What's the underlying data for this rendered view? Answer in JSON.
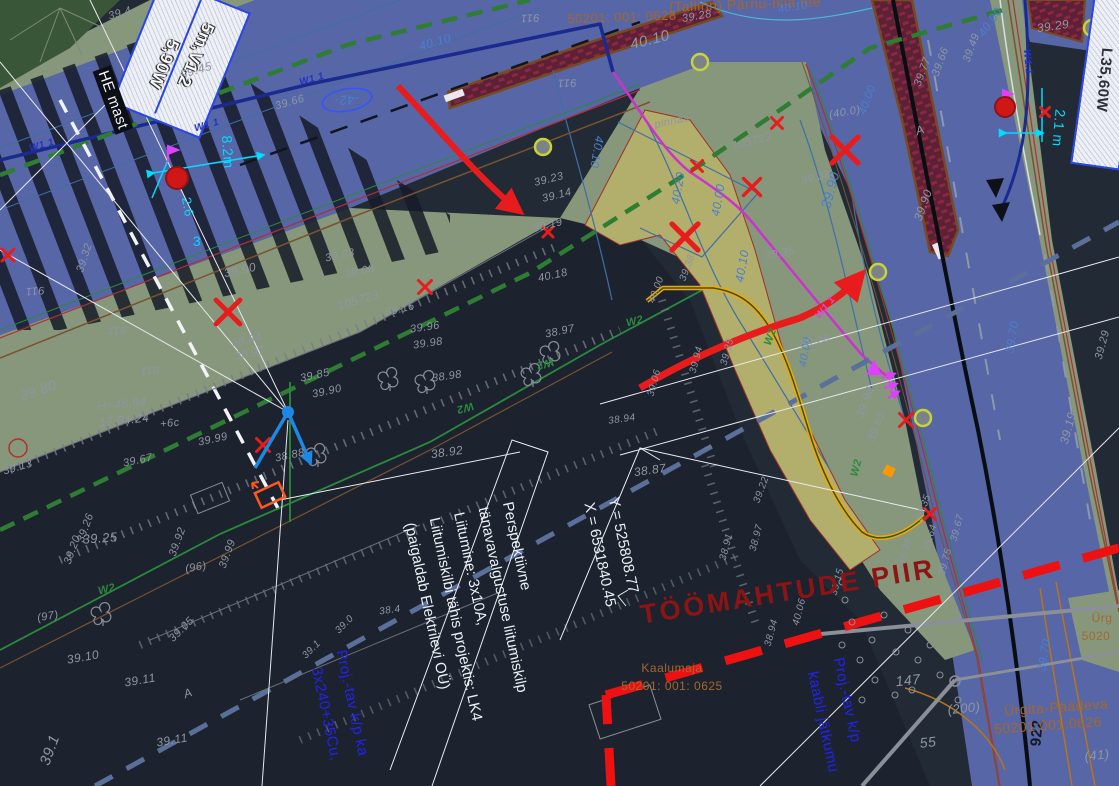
{
  "canvas": {
    "width": 1119,
    "height": 786,
    "background": "#222a36"
  },
  "colors": {
    "road_blue": "#5766a6",
    "verge_green": "#87977b",
    "khaki": "#b2ae6c",
    "forest": "#3a5639",
    "median_maroon": "#5c2136",
    "median_border": "#7a4a1f",
    "work_boundary_red": "#ee1111",
    "cable_orange": "#ffa000",
    "water_navy": "#1b2a8f",
    "water_magenta": "#cc33cc",
    "dash_green": "#2e7d32",
    "dash_slate": "#5a6f9a",
    "contour_blue": "#3d6fa8",
    "accent_cyan": "#00dcff"
  },
  "notes": {
    "main": {
      "x": 480,
      "y": 614,
      "rot": 78,
      "lines": [
        "Perspektiivne",
        "tänavavalgustuse liitumiskilp",
        "Liitumine: 3x10A,",
        "Liitumiskilbi tähis projektis: LK4",
        "(paigaldab Elektrilevi OÜ)"
      ]
    },
    "coords": {
      "x": 612,
      "y": 552,
      "rot": 78,
      "lines": [
        "Y = 525808.77",
        "X = 6531840.45"
      ]
    }
  },
  "labels": [
    {
      "t": "(Tallinn) Pärnu-Ikla tee",
      "x": 745,
      "y": 4,
      "r": -2,
      "s": 14,
      "c": "sienna"
    },
    {
      "t": "50201: 001: 0628",
      "x": 622,
      "y": 17,
      "r": -2,
      "s": 13,
      "c": "sienna"
    },
    {
      "t": "39.28",
      "x": 697,
      "y": 17,
      "r": -10,
      "s": 11,
      "c": "gray"
    },
    {
      "t": "40.10",
      "x": 650,
      "y": 40,
      "r": -14,
      "s": 15,
      "c": "gray"
    },
    {
      "t": "40.10",
      "x": 793,
      "y": 8,
      "r": -8,
      "s": 11,
      "c": "blue"
    },
    {
      "t": "40.10",
      "x": 435,
      "y": 42,
      "r": -16,
      "s": 12,
      "c": "blue"
    },
    {
      "t": "40.10",
      "x": 597,
      "y": 152,
      "r": 100,
      "s": 12,
      "c": "blue"
    },
    {
      "t": "40.00",
      "x": 990,
      "y": 22,
      "r": -55,
      "s": 12,
      "c": "blue"
    },
    {
      "t": "39.29",
      "x": 1053,
      "y": 26,
      "r": -8,
      "s": 12,
      "c": "gray"
    },
    {
      "t": "39.45",
      "x": 196,
      "y": 70,
      "r": -16,
      "s": 12,
      "c": "gray"
    },
    {
      "t": "39.4",
      "x": 120,
      "y": 14,
      "r": -16,
      "s": 11,
      "c": "gray"
    },
    {
      "t": "W1 1",
      "x": 42,
      "y": 146,
      "r": -16,
      "s": 10,
      "c": "navy"
    },
    {
      "t": "W1 1",
      "x": 207,
      "y": 126,
      "r": -16,
      "s": 10,
      "c": "navy"
    },
    {
      "t": "W1 1",
      "x": 312,
      "y": 80,
      "r": -16,
      "s": 10,
      "c": "navy"
    },
    {
      "t": "W1.1",
      "x": 1027,
      "y": 62,
      "r": 85,
      "s": 10,
      "c": "navy"
    },
    {
      "t": "W1 1",
      "x": 826,
      "y": 308,
      "r": -52,
      "s": 10,
      "c": "magenta"
    },
    {
      "t": "-42-",
      "x": 347,
      "y": 100,
      "r": 175,
      "s": 13,
      "c": "blue"
    },
    {
      "t": "911",
      "x": 530,
      "y": 17,
      "r": 178,
      "s": 11,
      "c": "gray"
    },
    {
      "t": "911",
      "x": 567,
      "y": 82,
      "r": 178,
      "s": 11,
      "c": "gray"
    },
    {
      "t": "911",
      "x": 35,
      "y": 290,
      "r": 175,
      "s": 11,
      "c": "gray"
    },
    {
      "t": "911",
      "x": 117,
      "y": 330,
      "r": 175,
      "s": 11,
      "c": "gray"
    },
    {
      "t": "911",
      "x": 150,
      "y": 370,
      "r": 175,
      "s": 11,
      "c": "gray"
    },
    {
      "t": "39.66",
      "x": 290,
      "y": 103,
      "r": -16,
      "s": 11,
      "c": "gray"
    },
    {
      "t": "8.2m",
      "x": 228,
      "y": 152,
      "r": 86,
      "s": 14,
      "c": "cyan"
    },
    {
      "t": "2.6",
      "x": 188,
      "y": 207,
      "r": 80,
      "s": 13,
      "c": "cyan"
    },
    {
      "t": "2.1 m",
      "x": 1059,
      "y": 128,
      "r": 95,
      "s": 14,
      "c": "cyan"
    },
    {
      "t": "3",
      "x": 197,
      "y": 241,
      "r": 0,
      "s": 14,
      "c": "cyan"
    },
    {
      "t": "HE mast",
      "x": 113,
      "y": 100,
      "r": 70,
      "s": 15,
      "c": "whitebox"
    },
    {
      "t": "5m,V1.2",
      "x": 196,
      "y": 55,
      "r": 113,
      "s": 17,
      "c": "whiteoutline"
    },
    {
      "t": "5,90W",
      "x": 164,
      "y": 64,
      "r": 113,
      "s": 17,
      "c": "whiteoutline"
    },
    {
      "t": "L35,60W",
      "x": 1104,
      "y": 80,
      "r": 95,
      "s": 15,
      "c": "dark"
    },
    {
      "t": "39.23",
      "x": 549,
      "y": 180,
      "r": -14,
      "s": 11,
      "c": "gray"
    },
    {
      "t": "39.14",
      "x": 557,
      "y": 196,
      "r": -14,
      "s": 11,
      "c": "gray"
    },
    {
      "t": "39.19",
      "x": 548,
      "y": 226,
      "r": -14,
      "s": 11,
      "c": "gray"
    },
    {
      "t": "pinnas",
      "x": 672,
      "y": 122,
      "r": -12,
      "s": 11,
      "c": "gray"
    },
    {
      "t": "105723",
      "x": 358,
      "y": 300,
      "r": -16,
      "s": 12,
      "c": "gray"
    },
    {
      "t": "105723",
      "x": 752,
      "y": 142,
      "r": -14,
      "s": 11,
      "c": "gray"
    },
    {
      "t": "39.03",
      "x": 340,
      "y": 256,
      "r": -12,
      "s": 11,
      "c": "gray"
    },
    {
      "t": "39.03",
      "x": 360,
      "y": 272,
      "r": -12,
      "s": 11,
      "c": "gray"
    },
    {
      "t": "39.16",
      "x": 400,
      "y": 310,
      "r": -14,
      "s": 11,
      "c": "gray"
    },
    {
      "t": "40.18",
      "x": 553,
      "y": 276,
      "r": -12,
      "s": 11,
      "c": "gray"
    },
    {
      "t": "39.96",
      "x": 425,
      "y": 328,
      "r": -8,
      "s": 11,
      "c": "gray"
    },
    {
      "t": "39.98",
      "x": 428,
      "y": 344,
      "r": -8,
      "s": 11,
      "c": "gray"
    },
    {
      "t": "38.97",
      "x": 560,
      "y": 332,
      "r": -12,
      "s": 11,
      "c": "gray"
    },
    {
      "t": "38.98",
      "x": 447,
      "y": 377,
      "r": -8,
      "s": 11,
      "c": "gray"
    },
    {
      "t": "38.92",
      "x": 447,
      "y": 452,
      "r": -8,
      "s": 12,
      "c": "gray"
    },
    {
      "t": "38.87",
      "x": 650,
      "y": 470,
      "r": -8,
      "s": 12,
      "c": "gray"
    },
    {
      "t": "39.85",
      "x": 315,
      "y": 376,
      "r": -12,
      "s": 11,
      "c": "gray"
    },
    {
      "t": "39.90",
      "x": 327,
      "y": 392,
      "r": -12,
      "s": 11,
      "c": "gray"
    },
    {
      "t": "39.80",
      "x": 38,
      "y": 390,
      "r": -18,
      "s": 14,
      "c": "gray"
    },
    {
      "t": "39.32",
      "x": 85,
      "y": 258,
      "r": -72,
      "s": 11,
      "c": "gray"
    },
    {
      "t": "39.90",
      "x": 240,
      "y": 270,
      "r": -12,
      "s": 12,
      "c": "gray"
    },
    {
      "t": "38.84",
      "x": 247,
      "y": 341,
      "r": -12,
      "s": 11,
      "c": "gray"
    },
    {
      "t": "38.97",
      "x": 250,
      "y": 354,
      "r": -12,
      "s": 11,
      "c": "gray"
    },
    {
      "t": "H=46.94",
      "x": 122,
      "y": 404,
      "r": -6,
      "s": 12,
      "c": "gray"
    },
    {
      "t": "17.04.24",
      "x": 124,
      "y": 420,
      "r": -6,
      "s": 12,
      "c": "gray"
    },
    {
      "t": "+6c",
      "x": 170,
      "y": 424,
      "r": -6,
      "s": 11,
      "c": "gray"
    },
    {
      "t": "39.99",
      "x": 213,
      "y": 440,
      "r": -12,
      "s": 11,
      "c": "gray"
    },
    {
      "t": "38.88",
      "x": 290,
      "y": 456,
      "r": -12,
      "s": 11,
      "c": "gray"
    },
    {
      "t": "39.13",
      "x": 18,
      "y": 468,
      "r": -16,
      "s": 11,
      "c": "gray"
    },
    {
      "t": "39.67",
      "x": 138,
      "y": 461,
      "r": -12,
      "s": 11,
      "c": "gray"
    },
    {
      "t": "39.25",
      "x": 100,
      "y": 538,
      "r": -4,
      "s": 13,
      "c": "gray"
    },
    {
      "t": "39.26",
      "x": 86,
      "y": 528,
      "r": -70,
      "s": 11,
      "c": "gray"
    },
    {
      "t": "39.20",
      "x": 73,
      "y": 550,
      "r": -70,
      "s": 11,
      "c": "gray"
    },
    {
      "t": "39.92",
      "x": 178,
      "y": 542,
      "r": -70,
      "s": 11,
      "c": "gray"
    },
    {
      "t": "39.99",
      "x": 228,
      "y": 554,
      "r": -70,
      "s": 11,
      "c": "gray"
    },
    {
      "t": "(96)",
      "x": 196,
      "y": 568,
      "r": -10,
      "s": 11,
      "c": "gray"
    },
    {
      "t": "(97)",
      "x": 48,
      "y": 617,
      "r": -10,
      "s": 11,
      "c": "gray"
    },
    {
      "t": "39.05",
      "x": 182,
      "y": 630,
      "r": -45,
      "s": 11,
      "c": "gray"
    },
    {
      "t": "39.10",
      "x": 83,
      "y": 657,
      "r": -10,
      "s": 12,
      "c": "gray"
    },
    {
      "t": "39.11",
      "x": 140,
      "y": 680,
      "r": -10,
      "s": 12,
      "c": "gray"
    },
    {
      "t": "39.11",
      "x": 172,
      "y": 740,
      "r": -10,
      "s": 12,
      "c": "gray"
    },
    {
      "t": "A",
      "x": 188,
      "y": 693,
      "r": -20,
      "s": 12,
      "c": "gray"
    },
    {
      "t": "A",
      "x": 920,
      "y": 130,
      "r": -20,
      "s": 12,
      "c": "gray"
    },
    {
      "t": "39.1",
      "x": 50,
      "y": 750,
      "r": -70,
      "s": 15,
      "c": "gray"
    },
    {
      "t": "W2",
      "x": 107,
      "y": 590,
      "r": -14,
      "s": 11,
      "c": "green"
    },
    {
      "t": "W2",
      "x": 545,
      "y": 363,
      "r": 165,
      "s": 11,
      "c": "green"
    },
    {
      "t": "W2",
      "x": 465,
      "y": 407,
      "r": 165,
      "s": 11,
      "c": "green"
    },
    {
      "t": "W2",
      "x": 635,
      "y": 322,
      "r": -14,
      "s": 11,
      "c": "green"
    },
    {
      "t": "W2",
      "x": 771,
      "y": 337,
      "r": -70,
      "s": 11,
      "c": "green"
    },
    {
      "t": "W2",
      "x": 857,
      "y": 468,
      "r": -75,
      "s": 11,
      "c": "green"
    },
    {
      "t": "40.20",
      "x": 678,
      "y": 188,
      "r": -80,
      "s": 12,
      "c": "blue"
    },
    {
      "t": "40.00",
      "x": 718,
      "y": 200,
      "r": -80,
      "s": 12,
      "c": "blue"
    },
    {
      "t": "40.10",
      "x": 742,
      "y": 266,
      "r": -80,
      "s": 12,
      "c": "blue"
    },
    {
      "t": "39.90",
      "x": 830,
      "y": 190,
      "r": -75,
      "s": 14,
      "c": "blue"
    },
    {
      "t": "40.00",
      "x": 806,
      "y": 352,
      "r": -80,
      "s": 11,
      "c": "blue"
    },
    {
      "t": "39.36",
      "x": 816,
      "y": 178,
      "r": -12,
      "s": 11,
      "c": "gray"
    },
    {
      "t": "39.36",
      "x": 780,
      "y": 254,
      "r": -12,
      "s": 11,
      "c": "gray"
    },
    {
      "t": "(40.0)",
      "x": 845,
      "y": 113,
      "r": -10,
      "s": 11,
      "c": "gray"
    },
    {
      "t": "39.90",
      "x": 923,
      "y": 205,
      "r": -70,
      "s": 12,
      "c": "gray"
    },
    {
      "t": "39.77",
      "x": 923,
      "y": 72,
      "r": -70,
      "s": 11,
      "c": "gray"
    },
    {
      "t": "39.66",
      "x": 941,
      "y": 62,
      "r": -70,
      "s": 11,
      "c": "gray"
    },
    {
      "t": "39.49",
      "x": 972,
      "y": 48,
      "r": -70,
      "s": 11,
      "c": "gray"
    },
    {
      "t": "40.00",
      "x": 868,
      "y": 100,
      "r": -70,
      "s": 11,
      "c": "blue"
    },
    {
      "t": "39.70",
      "x": 1012,
      "y": 337,
      "r": -80,
      "s": 12,
      "c": "blue"
    },
    {
      "t": "39.70",
      "x": 1044,
      "y": 655,
      "r": -80,
      "s": 12,
      "c": "blue"
    },
    {
      "t": "39.19",
      "x": 1068,
      "y": 428,
      "r": -75,
      "s": 12,
      "c": "gray"
    },
    {
      "t": "39.29",
      "x": 1103,
      "y": 345,
      "r": -75,
      "s": 11,
      "c": "gray"
    },
    {
      "t": "39.38",
      "x": 906,
      "y": 552,
      "r": -75,
      "s": 10,
      "c": "gray"
    },
    {
      "t": "39.64",
      "x": 931,
      "y": 538,
      "r": -75,
      "s": 10,
      "c": "gray"
    },
    {
      "t": "39.75",
      "x": 946,
      "y": 562,
      "r": -75,
      "s": 10,
      "c": "gray"
    },
    {
      "t": "39.67",
      "x": 958,
      "y": 528,
      "r": -75,
      "s": 10,
      "c": "gray"
    },
    {
      "t": "39.90",
      "x": 865,
      "y": 402,
      "r": -70,
      "s": 12,
      "c": "gray"
    },
    {
      "t": "39.63",
      "x": 877,
      "y": 427,
      "r": -70,
      "s": 11,
      "c": "gray"
    },
    {
      "t": "39.28",
      "x": 815,
      "y": 342,
      "r": -12,
      "s": 11,
      "c": "gray"
    },
    {
      "t": "39.35",
      "x": 924,
      "y": 508,
      "r": -70,
      "s": 10,
      "c": "gray"
    },
    {
      "t": "39.38",
      "x": 688,
      "y": 268,
      "r": -70,
      "s": 10,
      "c": "gray"
    },
    {
      "t": "40.00",
      "x": 657,
      "y": 290,
      "r": -70,
      "s": 10,
      "c": "gray"
    },
    {
      "t": "39.06",
      "x": 655,
      "y": 383,
      "r": -75,
      "s": 10,
      "c": "gray"
    },
    {
      "t": "39.94",
      "x": 697,
      "y": 360,
      "r": -75,
      "s": 10,
      "c": "gray"
    },
    {
      "t": "39.35",
      "x": 728,
      "y": 352,
      "r": -75,
      "s": 10,
      "c": "gray"
    },
    {
      "t": "38.94",
      "x": 622,
      "y": 420,
      "r": -8,
      "s": 10,
      "c": "gray"
    },
    {
      "t": "39.22",
      "x": 762,
      "y": 490,
      "r": -70,
      "s": 10,
      "c": "gray"
    },
    {
      "t": "38.97",
      "x": 757,
      "y": 538,
      "r": -75,
      "s": 10,
      "c": "gray"
    },
    {
      "t": "38.91",
      "x": 727,
      "y": 547,
      "r": -75,
      "s": 10,
      "c": "gray"
    },
    {
      "t": "40.06",
      "x": 800,
      "y": 612,
      "r": -75,
      "s": 10,
      "c": "gray"
    },
    {
      "t": "38.94",
      "x": 772,
      "y": 633,
      "r": -75,
      "s": 10,
      "c": "gray"
    },
    {
      "t": "39.15",
      "x": 838,
      "y": 582,
      "r": -75,
      "s": 10,
      "c": "gray"
    },
    {
      "t": "38.4",
      "x": 390,
      "y": 611,
      "r": -8,
      "s": 10,
      "c": "gray"
    },
    {
      "t": "39.0",
      "x": 345,
      "y": 625,
      "r": -45,
      "s": 10,
      "c": "gray"
    },
    {
      "t": "39.1",
      "x": 312,
      "y": 650,
      "r": -45,
      "s": 10,
      "c": "gray"
    },
    {
      "t": "TÖÖMAHTUDE PIIR",
      "x": 788,
      "y": 592,
      "r": -9,
      "s": 27,
      "c": "darkred"
    },
    {
      "t": "Kaalumaja",
      "x": 672,
      "y": 668,
      "r": 0,
      "s": 12,
      "c": "sienna"
    },
    {
      "t": "50201: 001: 0625",
      "x": 672,
      "y": 686,
      "r": 0,
      "s": 12,
      "c": "sienna"
    },
    {
      "t": "Proj.-tav k/p ka",
      "x": 352,
      "y": 703,
      "r": 78,
      "s": 15,
      "c": "bluebright"
    },
    {
      "t": "3x240+35Cu,",
      "x": 326,
      "y": 714,
      "r": 78,
      "s": 15,
      "c": "bluebright"
    },
    {
      "t": "Proj.-tav k/p",
      "x": 847,
      "y": 700,
      "r": 78,
      "s": 15,
      "c": "bluebright"
    },
    {
      "t": "kaabli jätkumu",
      "x": 823,
      "y": 722,
      "r": 78,
      "s": 15,
      "c": "bluebright"
    },
    {
      "t": "147",
      "x": 908,
      "y": 680,
      "r": -6,
      "s": 14,
      "c": "gray"
    },
    {
      "t": "55",
      "x": 928,
      "y": 742,
      "r": -6,
      "s": 14,
      "c": "gray"
    },
    {
      "t": "(200)",
      "x": 964,
      "y": 708,
      "r": -6,
      "s": 13,
      "c": "gray"
    },
    {
      "t": "(41)",
      "x": 1097,
      "y": 755,
      "r": -6,
      "s": 13,
      "c": "gray"
    },
    {
      "t": "922",
      "x": 1037,
      "y": 733,
      "r": -85,
      "s": 15,
      "c": "dark2"
    },
    {
      "t": "Ürgita-Päädeva",
      "x": 1056,
      "y": 707,
      "r": -4,
      "s": 14,
      "c": "sienna"
    },
    {
      "t": "50201:001:0626",
      "x": 1048,
      "y": 725,
      "r": -4,
      "s": 14,
      "c": "sienna"
    },
    {
      "t": "Ürg",
      "x": 1102,
      "y": 618,
      "r": 0,
      "s": 12,
      "c": "sienna"
    },
    {
      "t": "5020",
      "x": 1096,
      "y": 636,
      "r": 0,
      "s": 12,
      "c": "sienna"
    }
  ],
  "symbols": {
    "x_marks": [
      {
        "x": 228,
        "y": 312,
        "s": 24
      },
      {
        "x": 263,
        "y": 445,
        "s": 13
      },
      {
        "x": 425,
        "y": 287,
        "s": 13
      },
      {
        "x": 548,
        "y": 232,
        "s": 10
      },
      {
        "x": 685,
        "y": 237,
        "s": 26
      },
      {
        "x": 752,
        "y": 187,
        "s": 17
      },
      {
        "x": 845,
        "y": 150,
        "s": 26
      },
      {
        "x": 697,
        "y": 166,
        "s": 11
      },
      {
        "x": 777,
        "y": 123,
        "s": 11
      },
      {
        "x": 906,
        "y": 420,
        "s": 13
      },
      {
        "x": 930,
        "y": 514,
        "s": 11
      },
      {
        "x": 8,
        "y": 255,
        "s": 12
      },
      {
        "x": 185,
        "y": 72,
        "s": 9
      },
      {
        "x": 1045,
        "y": 112,
        "s": 9
      }
    ],
    "luminaires": [
      {
        "x": 177,
        "y": 178,
        "rr": 11
      },
      {
        "x": 1005,
        "y": 107,
        "rr": 10
      }
    ],
    "circle_outlines": [
      {
        "x": 18,
        "y": 448,
        "rr": 9
      }
    ],
    "tree_rings": [
      {
        "x": 543,
        "y": 147
      },
      {
        "x": 700,
        "y": 62
      },
      {
        "x": 878,
        "y": 272
      },
      {
        "x": 923,
        "y": 418
      },
      {
        "x": 1092,
        "y": 28
      }
    ],
    "trees": [
      {
        "x": 390,
        "y": 382
      },
      {
        "x": 427,
        "y": 385
      },
      {
        "x": 533,
        "y": 378
      },
      {
        "x": 552,
        "y": 356
      },
      {
        "x": 318,
        "y": 458
      },
      {
        "x": 103,
        "y": 617
      }
    ],
    "bushes": [
      {
        "x": 845,
        "y": 600
      },
      {
        "x": 852,
        "y": 622
      },
      {
        "x": 842,
        "y": 645
      },
      {
        "x": 860,
        "y": 660
      },
      {
        "x": 872,
        "y": 640
      },
      {
        "x": 884,
        "y": 615
      },
      {
        "x": 896,
        "y": 652
      },
      {
        "x": 908,
        "y": 630
      },
      {
        "x": 918,
        "y": 660
      },
      {
        "x": 930,
        "y": 645
      },
      {
        "x": 875,
        "y": 680
      },
      {
        "x": 895,
        "y": 695
      },
      {
        "x": 862,
        "y": 700
      },
      {
        "x": 912,
        "y": 690
      },
      {
        "x": 940,
        "y": 675
      },
      {
        "x": 958,
        "y": 700
      },
      {
        "x": 842,
        "y": 582
      }
    ],
    "pole": {
      "x": 288,
      "y": 412
    },
    "cabinet": {
      "x": 270,
      "y": 495
    }
  }
}
